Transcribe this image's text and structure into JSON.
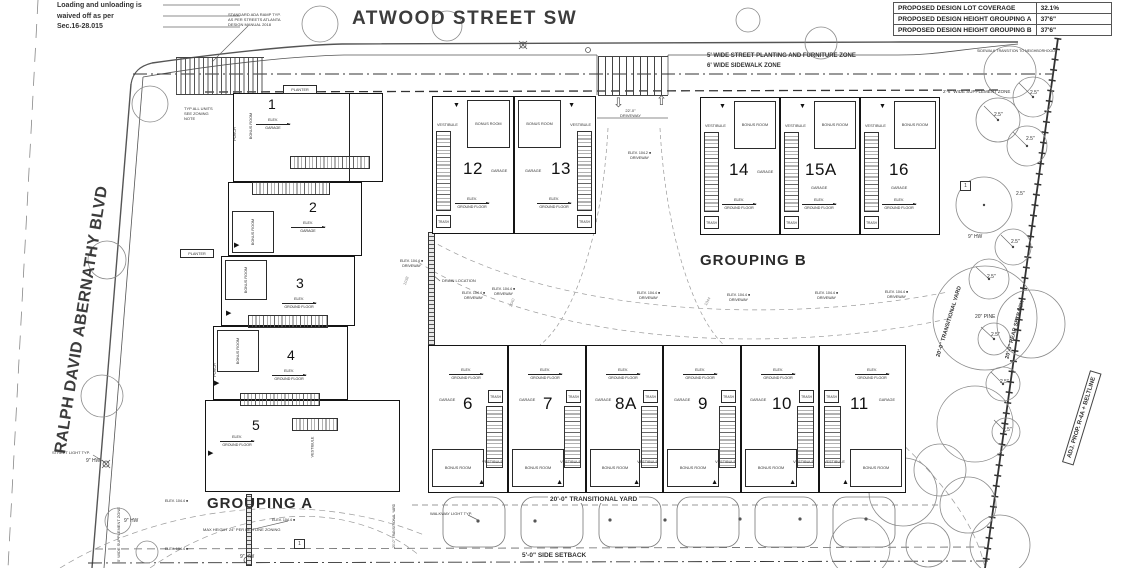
{
  "streets": {
    "top": "ATWOOD STREET SW",
    "left": "RALPH DAVID ABERNATHY BLVD"
  },
  "design_table": {
    "rows": [
      {
        "label": "PROPOSED DESIGN LOT COVERAGE",
        "value": "32.1%"
      },
      {
        "label": "PROPOSED DESIGN HEIGHT GROUPING A",
        "value": "37'6\""
      },
      {
        "label": "PROPOSED DESIGN HEIGHT GROUPING B",
        "value": "37'6\""
      }
    ]
  },
  "notes": {
    "loading_1": "Loading and unloading is",
    "loading_2": "waived off as per",
    "loading_3": "Sec.16-28.015",
    "ada_1": "STANDARD ADA RAMP TYP.",
    "ada_2": "AS PER STREETS ATLANTA",
    "ada_3": "DESIGN MANUAL 2018",
    "sidewalk_transition": "SIDEWALK TRANSITION TO NEIGHBORHOOD",
    "typ_units_1": "TYP ALL UNITS",
    "typ_units_2": "SEE ZONING",
    "typ_units_3": "NOTE",
    "street_light": "STREET LIGHT TYP.",
    "walkway_light": "WALKWAY LIGHT TYP.",
    "max_height": "MAX HEIGHT 24\" PER BELTLINE ZONING",
    "drain": "DRAIN LOCATION"
  },
  "zones": {
    "planting": "5' WIDE STREET PLANTING AND FURNITURE ZONE",
    "sidewalk": "6' WIDE SIDEWALK ZONE",
    "supplement_right": "2'-6\" WIDE SUPPLEMENT ZONE",
    "supplement_left": "5' WIDE SUPPLEMENT ZONE"
  },
  "groupings": {
    "a": "GROUPING A",
    "b": "GROUPING B"
  },
  "setbacks": {
    "transitional_yard": "20'-0\" TRANSITIONAL YARD",
    "rear": "20'-0\" REAR SETBACK",
    "side": "5'-0\" SIDE SETBACK",
    "adjacent": "ADJ. PROP. R-4A + BELTLINE"
  },
  "units": {
    "u1": "1",
    "u2": "2",
    "u3": "3",
    "u4": "4",
    "u5": "5",
    "u6": "6",
    "u7": "7",
    "u8a": "8A",
    "u9": "9",
    "u10": "10",
    "u11": "11",
    "u12": "12",
    "u13": "13",
    "u14": "14",
    "u15a": "15A",
    "u16": "16"
  },
  "rooms": {
    "garage": "GARAGE",
    "bonus": "BONUS ROOM",
    "vestibule": "VESTIBULE",
    "trash": "TRASH",
    "porch": "PORCH",
    "planter": "PLANTER"
  },
  "elev": {
    "label": "ELEV.",
    "ground": "GROUND FLOOR"
  },
  "driveway": {
    "dim": "22'-0\"",
    "label": "DRIVEWAY",
    "entry_elev": "ELEV. 104.2",
    "court_elev": "ELEV. 104.4"
  },
  "trees": {
    "dia_small": "2.5\"",
    "pine": "20\" PINE",
    "hardwood": "9\" HW"
  },
  "contours": {
    "c1": "1038",
    "c2": "1040",
    "c3": "1044"
  },
  "keynote": "1"
}
